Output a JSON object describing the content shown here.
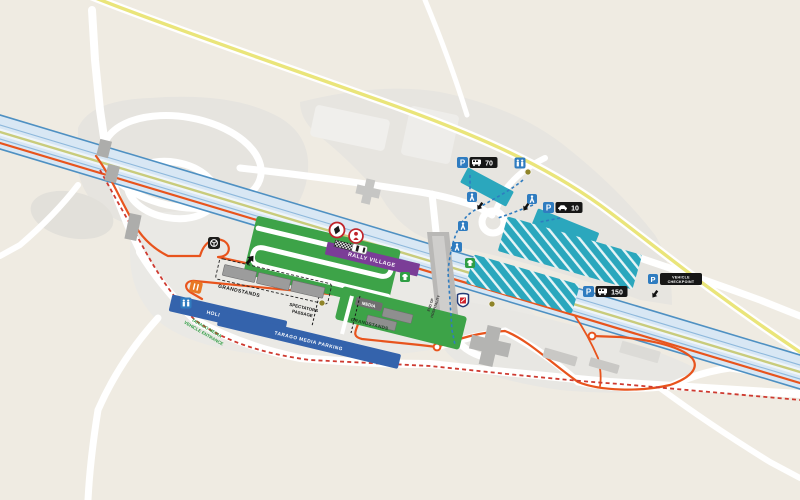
{
  "map": {
    "type": "rally-venue-service-park-map",
    "labels": {
      "rally_village": "RALLY VILLAGE",
      "grandstands_north": "GRANDSTANDS",
      "grandstands_south": "GRANDSTANDS",
      "holding_area": "HOLDING AREA",
      "tarago_media_parking": "TARAGO MEDIA PARKING",
      "tarago_entrance_line1": "TARAGO MEDIA",
      "tarago_entrance_line2": "VEHICLE ENTRANCE",
      "spectators_line1": "SPECTATORS",
      "spectators_line2": "PASSAGE",
      "media": "MEDIA",
      "hospitality_line1": "END OF",
      "hospitality_line2": "HOSPITALITY"
    },
    "badges": {
      "parking_70": {
        "symbol": "P",
        "count": "70",
        "vehicle": "bus-icon"
      },
      "parking_10": {
        "symbol": "P",
        "count": "10",
        "vehicle": "car-icon"
      },
      "parking_150": {
        "symbol": "P",
        "count": "150",
        "vehicle": "bus-icon"
      },
      "vehicle_checkpoint": {
        "symbol": "P",
        "line1": "VEHICLE",
        "line2": "CHECKPOINT"
      }
    },
    "icons": [
      "toilets-icon",
      "pedestrian-crossing-icon",
      "food-drink-icon",
      "merchandise-icon",
      "service-park-steering-icon",
      "spectator-point-icon",
      "autograph-point-icon",
      "hospitality-shield-icon",
      "marshal-point-icon",
      "start-line-checker",
      "rally-car-icon",
      "direction-arrow-icon"
    ],
    "colors": {
      "background": "#EFEBE2",
      "ground_gray": "#E7E5E0",
      "road_white": "#FFFFFF",
      "highway_band": "#D8E7F4",
      "highway_edge": "#4E90C2",
      "highway_center": "#EFF5FA",
      "olive_stripe": "#C9CC7C",
      "yellow_road": "#EAE57A",
      "route_orange": "#E8541D",
      "route_red_dashed": "#CE3A30",
      "pedestrian_blue": "#2F7CC0",
      "parking_teal": "#2BA7BD",
      "zone_green": "#3DA348",
      "zone_blue": "#3463AC",
      "village_purple": "#7B3D97",
      "stand_gray": "#9C9C9C",
      "bridge_gray": "#B5B5B3",
      "badge_black": "#161616",
      "p_blue": "#2F7CC0",
      "food_orange": "#E87824",
      "marshal_olive": "#8F8428",
      "poi_red": "#C0242B",
      "entrance_green_text": "#2F9E44"
    }
  }
}
